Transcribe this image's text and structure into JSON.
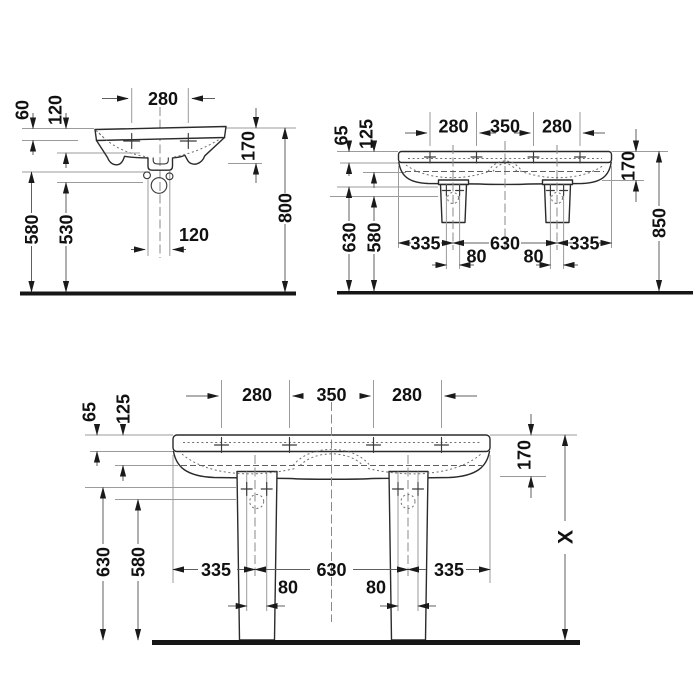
{
  "drawing": {
    "title": "Washbasin technical dimension drawing",
    "units": "mm",
    "colors": {
      "background": "#ffffff",
      "outline": "#2b2b2b",
      "dimension": "#5f5f5f",
      "extension": "#9b9b9b",
      "text": "#111111",
      "ground": "#161616"
    }
  },
  "views": {
    "v1": {
      "name": "single-washbasin-front-elevation",
      "tap_spacing": "280",
      "rim_to_shelf": "60",
      "rim_to_edge": "120",
      "basin_depth": "170",
      "outlet_height": "580",
      "trap_height": "530",
      "bolt_spacing": "120",
      "rim_height": "800"
    },
    "v2": {
      "name": "double-washbasin-half-pedestal-front-elevation",
      "tap_left": "280",
      "tap_center": "350",
      "tap_right": "280",
      "rim_to_shelf": "65",
      "rim_to_edge": "125",
      "basin_depth": "170",
      "outlet_height": "630",
      "trap_height": "580",
      "edge_to_pedestal_left": "335",
      "pedestal_spacing": "630",
      "edge_to_pedestal_right": "335",
      "pipe_width_left": "80",
      "pipe_width_right": "80",
      "rim_height": "850"
    },
    "v3": {
      "name": "double-washbasin-full-pedestal-front-elevation",
      "tap_left": "280",
      "tap_center": "350",
      "tap_right": "280",
      "rim_to_shelf": "65",
      "rim_to_edge": "125",
      "basin_depth": "170",
      "outlet_height": "630",
      "trap_height": "580",
      "edge_to_pedestal_left": "335",
      "pedestal_spacing": "630",
      "edge_to_pedestal_right": "335",
      "pipe_width_left": "80",
      "pipe_width_right": "80",
      "rim_height": "X"
    }
  }
}
